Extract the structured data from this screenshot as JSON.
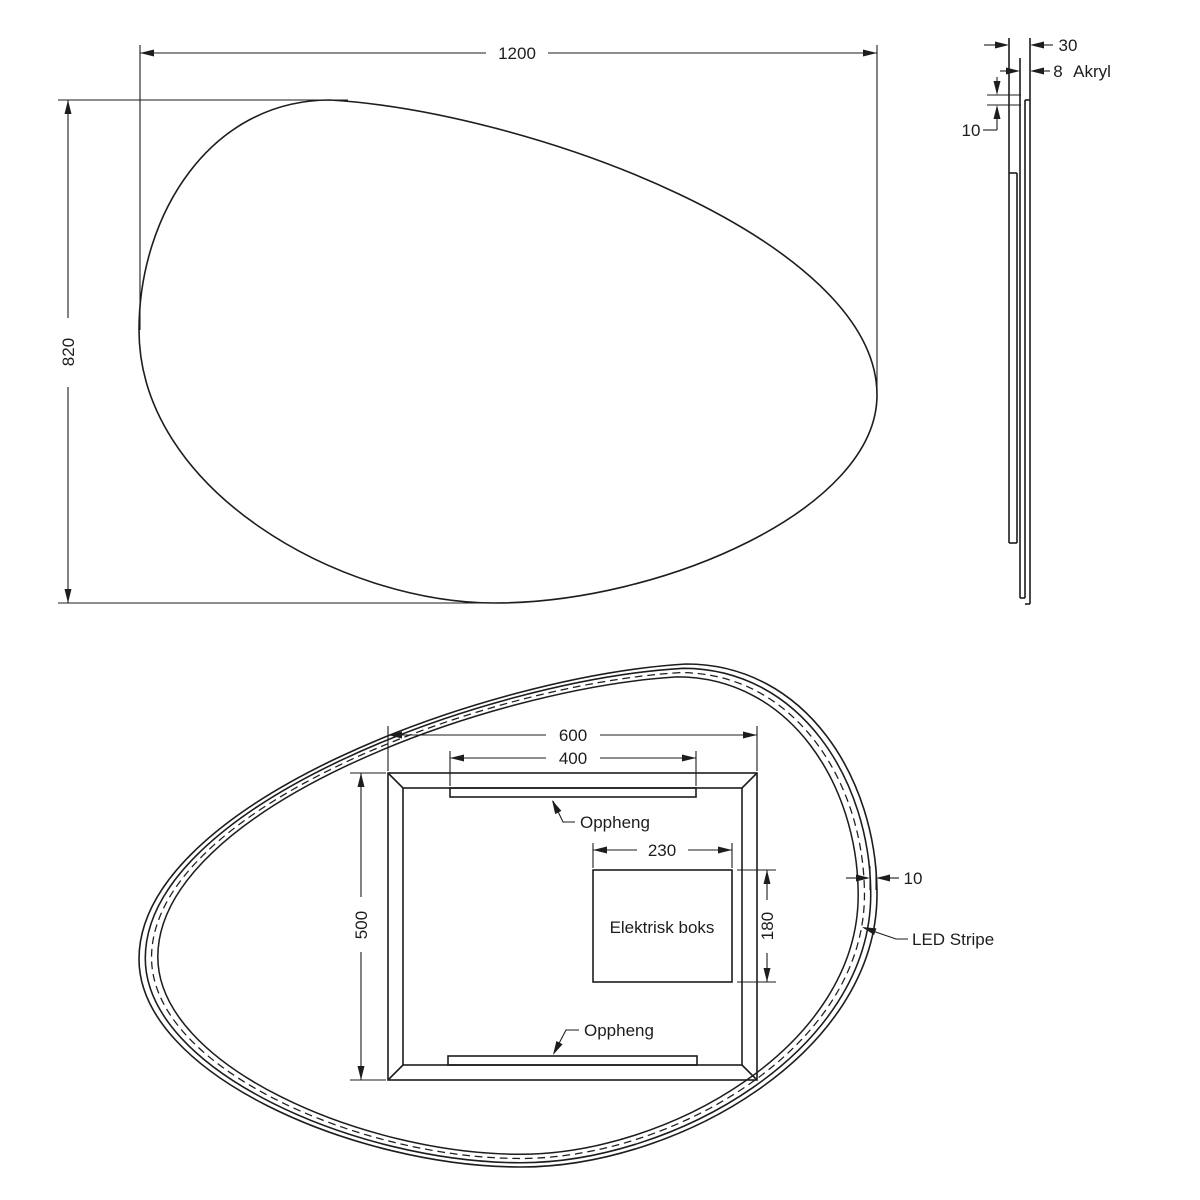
{
  "front_view": {
    "width": "1200",
    "height": "820"
  },
  "side_view": {
    "total_depth": "30",
    "acrylic_thickness": "8",
    "acrylic_material": "Akryl",
    "panel_offset": "10"
  },
  "back_view": {
    "frame_width": "600",
    "hanger_width": "400",
    "frame_height": "500",
    "box_width": "230",
    "box_height": "180",
    "box_label": "Elektrisk boks",
    "hanger_top_label": "Oppheng",
    "hanger_bottom_label": "Oppheng",
    "edge_offset": "10",
    "led_label": "LED Stripe"
  },
  "colors": {
    "line": "#1d1d1b",
    "background": "#ffffff"
  }
}
